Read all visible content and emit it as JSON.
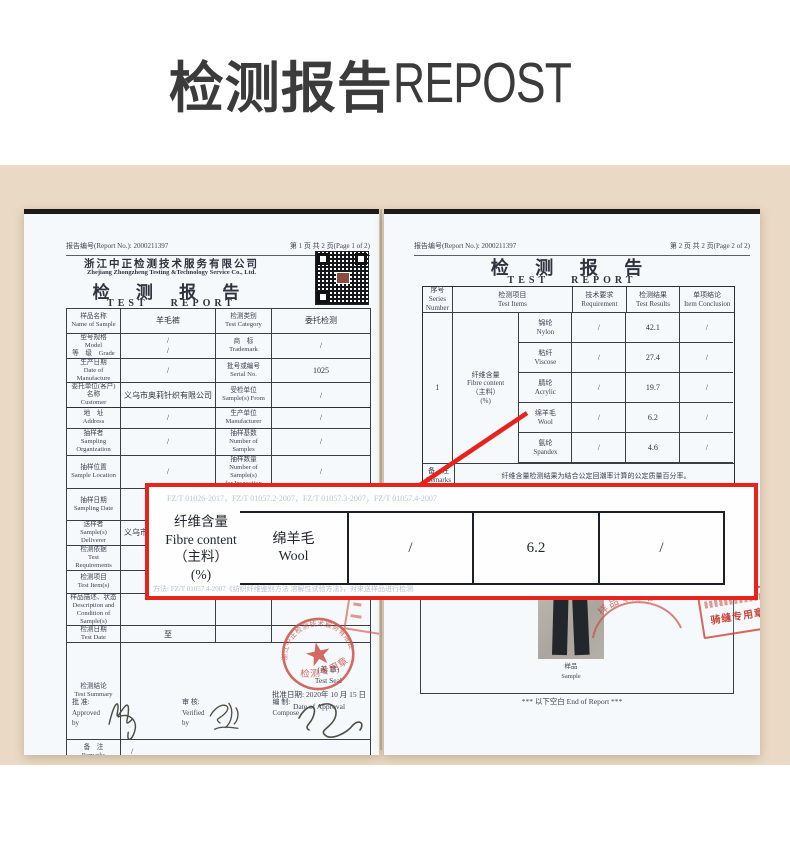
{
  "colors": {
    "accent_red": "#e8231b",
    "stamp_red": "#cc4a40",
    "beige_bg": "#ead9c4",
    "paper": "#f6f9fc",
    "title_ink": "#3b3b3b"
  },
  "banner": {
    "title_cn": "检测报告",
    "title_en": "REPOST"
  },
  "page1": {
    "report_no_label": "报告编号(Report No.):  2000211397",
    "page_no": "第 1 页 共 2 页(Page 1 of 2)",
    "company_cn": "浙江中正检测技术服务有限公司",
    "company_en": "Zhejiang Zhongzheng Testing &Technology Service Co., Ltd.",
    "doc_title_cn": "检 测 报 告",
    "doc_title_en_1": "TEST",
    "doc_title_en_2": "REPORT",
    "qr_caption": "········",
    "info_rows": [
      {
        "c1": "样品名称\nName of Sample",
        "c2": "羊毛裤",
        "c3": "检测类别\nTest Category",
        "c4": "委托检测"
      },
      {
        "c1": "型号规格　Model\n等　级　Grade",
        "c2": "/\n/",
        "c3": "商　标\nTrademark",
        "c4": "/"
      },
      {
        "c1": "生产日期\nDate of Manufacture",
        "c2": "/",
        "c3": "批号或编号\nSerial No.",
        "c4": "1025"
      },
      {
        "c1": "委托单位(客户)名称\nCustomer",
        "c2": "义乌市奥莉针织有限公司",
        "c3": "受检单位\nSample(s) From",
        "c4": "/"
      },
      {
        "c1": "地　址\nAddress",
        "c2": "/",
        "c3": "生产单位\nManufacturer",
        "c4": "/"
      },
      {
        "c1": "抽样者\nSampling Organization",
        "c2": "/",
        "c3": "抽样基数\nNumber of Samples",
        "c4": "/"
      },
      {
        "c1": "抽样位置\nSample Location",
        "c2": "/",
        "c3": "抽样数量\nNumber of Sample(s)\nfor Inspection",
        "c4": "/"
      },
      {
        "c1": "抽样日期\nSampling Date",
        "c2": "/",
        "c3": "到样数量\nReceiving Number of\nSample(s)",
        "c4": "1 条"
      },
      {
        "c1": "送样者\nSample(s) Deliverer",
        "c2": "义乌市奥莉针织有限公司",
        "c3": "到样日期\nReceiving Date of\nSample(s)",
        "c4": "2020 年 10 月 15 日"
      },
      {
        "c1": "检测依据\nTest Requirements",
        "c2": "",
        "c3": "",
        "c4": ""
      },
      {
        "c1": "检测项目\nTest Item(s)",
        "c2": "",
        "c3": "",
        "c4": ""
      },
      {
        "c1": "样品描述、状态\nDescription and\nCondition of Sample(s)",
        "c2": "",
        "c3": "",
        "c4": ""
      },
      {
        "c1": "检测日期\nTest Date",
        "c2": "至",
        "c3": "",
        "c4": ""
      }
    ],
    "summary_label": "检测结论\nTest Summary",
    "seal_note": "(盖  章)\nTest Seal",
    "approval_date": "批准日期: 2020年 10 月 15 日\nDate of Approval",
    "remarks_label": "备　注\nRemarks",
    "remarks_value": "/",
    "sign_approve": "批  准:\nApproved by",
    "sign_verify": "审  核:\nVerified by",
    "sign_compose": "编  制:\nCompose",
    "stamp_company_arc": "浙江中正检测技术服务有限公司",
    "stamp_text": "检测专用章"
  },
  "page2": {
    "report_no_label": "报告编号(Report No.):  2000211397",
    "page_no": "第 2 页 共 2 页(Page 2 of 2)",
    "doc_title_cn": "检 测 报 告",
    "doc_title_en_1": "TEST",
    "doc_title_en_2": "REPORT",
    "col_headers": [
      "序号\nSeries\nNumber",
      "检测项目\nTest Items",
      "技术要求\nRequirement",
      "检测结果\nTest Results",
      "单项结论\nItem Conclusion"
    ],
    "series_no": "1",
    "group_label": "纤维含量\nFibre content\n（主料）\n(%)",
    "fiber_rows": [
      {
        "name": "锦纶\nNylon",
        "req": "/",
        "result": "42.1",
        "concl": "/"
      },
      {
        "name": "粘纤\nViscose",
        "req": "/",
        "result": "27.4",
        "concl": "/"
      },
      {
        "name": "腈纶\nAcrylic",
        "req": "/",
        "result": "19.7",
        "concl": "/"
      },
      {
        "name": "绵羊毛\nWool",
        "req": "/",
        "result": "6.2",
        "concl": "/"
      },
      {
        "name": "氨纶\nSpandex",
        "req": "/",
        "result": "4.6",
        "concl": "/"
      }
    ],
    "remarks_label": "备　注\nRemarks",
    "remarks_value": "纤维含量检测结果为结合公定回潮率计算的公定质量百分率。",
    "photo_caption": "样品\nSample",
    "end_text": "*** 以下空白 End of Report ***",
    "stamp_sample": "样品专用章",
    "stamp_paging": "骑缝专用章"
  },
  "callout": {
    "faint_top": "FZ/T 01026-2017，FZ/T 01057.2-2007，FZ/T 01057.3-2007，FZ/T 01057.4-2007",
    "label": "纤维含量\nFibre content\n（主料）\n(%)",
    "cell_name": "绵羊毛\nWool",
    "cell_req": "/",
    "cell_result": "6.2",
    "cell_concl": "/",
    "faint_bottom": "方法: FZ/T 01057.4-2007《纺织纤维鉴别方法 溶解性试验方法》，对来送样品进行检测."
  }
}
